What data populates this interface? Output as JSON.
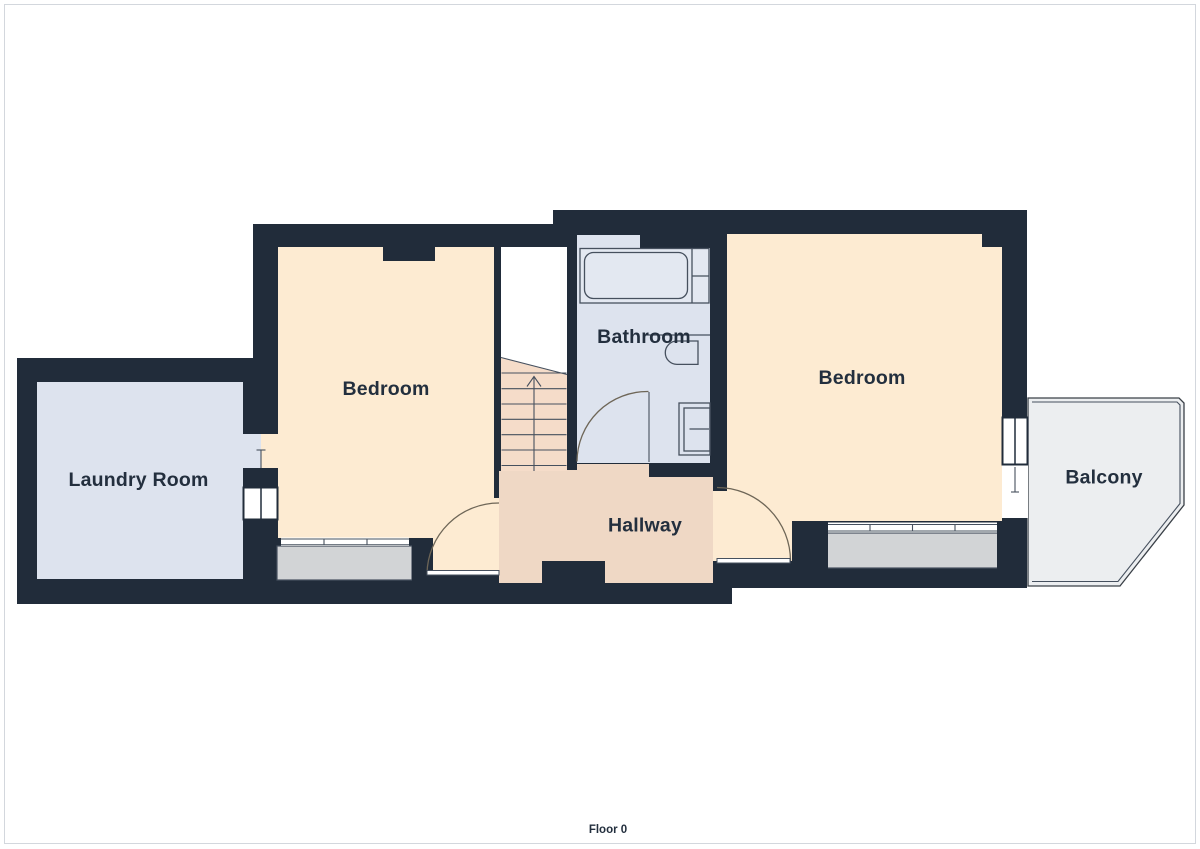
{
  "title": "Floor plan",
  "floor": {
    "label": "Floor 0"
  },
  "rooms": {
    "laundry": {
      "label": "Laundry Room"
    },
    "bedroom_left": {
      "label": "Bedroom"
    },
    "bathroom": {
      "label": "Bathroom"
    },
    "hallway": {
      "label": "Hallway"
    },
    "bedroom_right": {
      "label": "Bedroom"
    },
    "balcony": {
      "label": "Balcony"
    }
  },
  "colors": {
    "wall": "#212c3a",
    "bedroom": "#fdebd2",
    "hallway": "#efd8c5",
    "stairs": "#f5dcc9",
    "wet_room": "#dde3ee",
    "tub_fill": "#e3e8f1",
    "bay": "#d2d4d6",
    "balcony": "#eceef0",
    "label_text": "#232f3e",
    "fixture_stroke": "#46505e",
    "door_arc": "#6e6657",
    "page_border": "#d3d7dd"
  }
}
